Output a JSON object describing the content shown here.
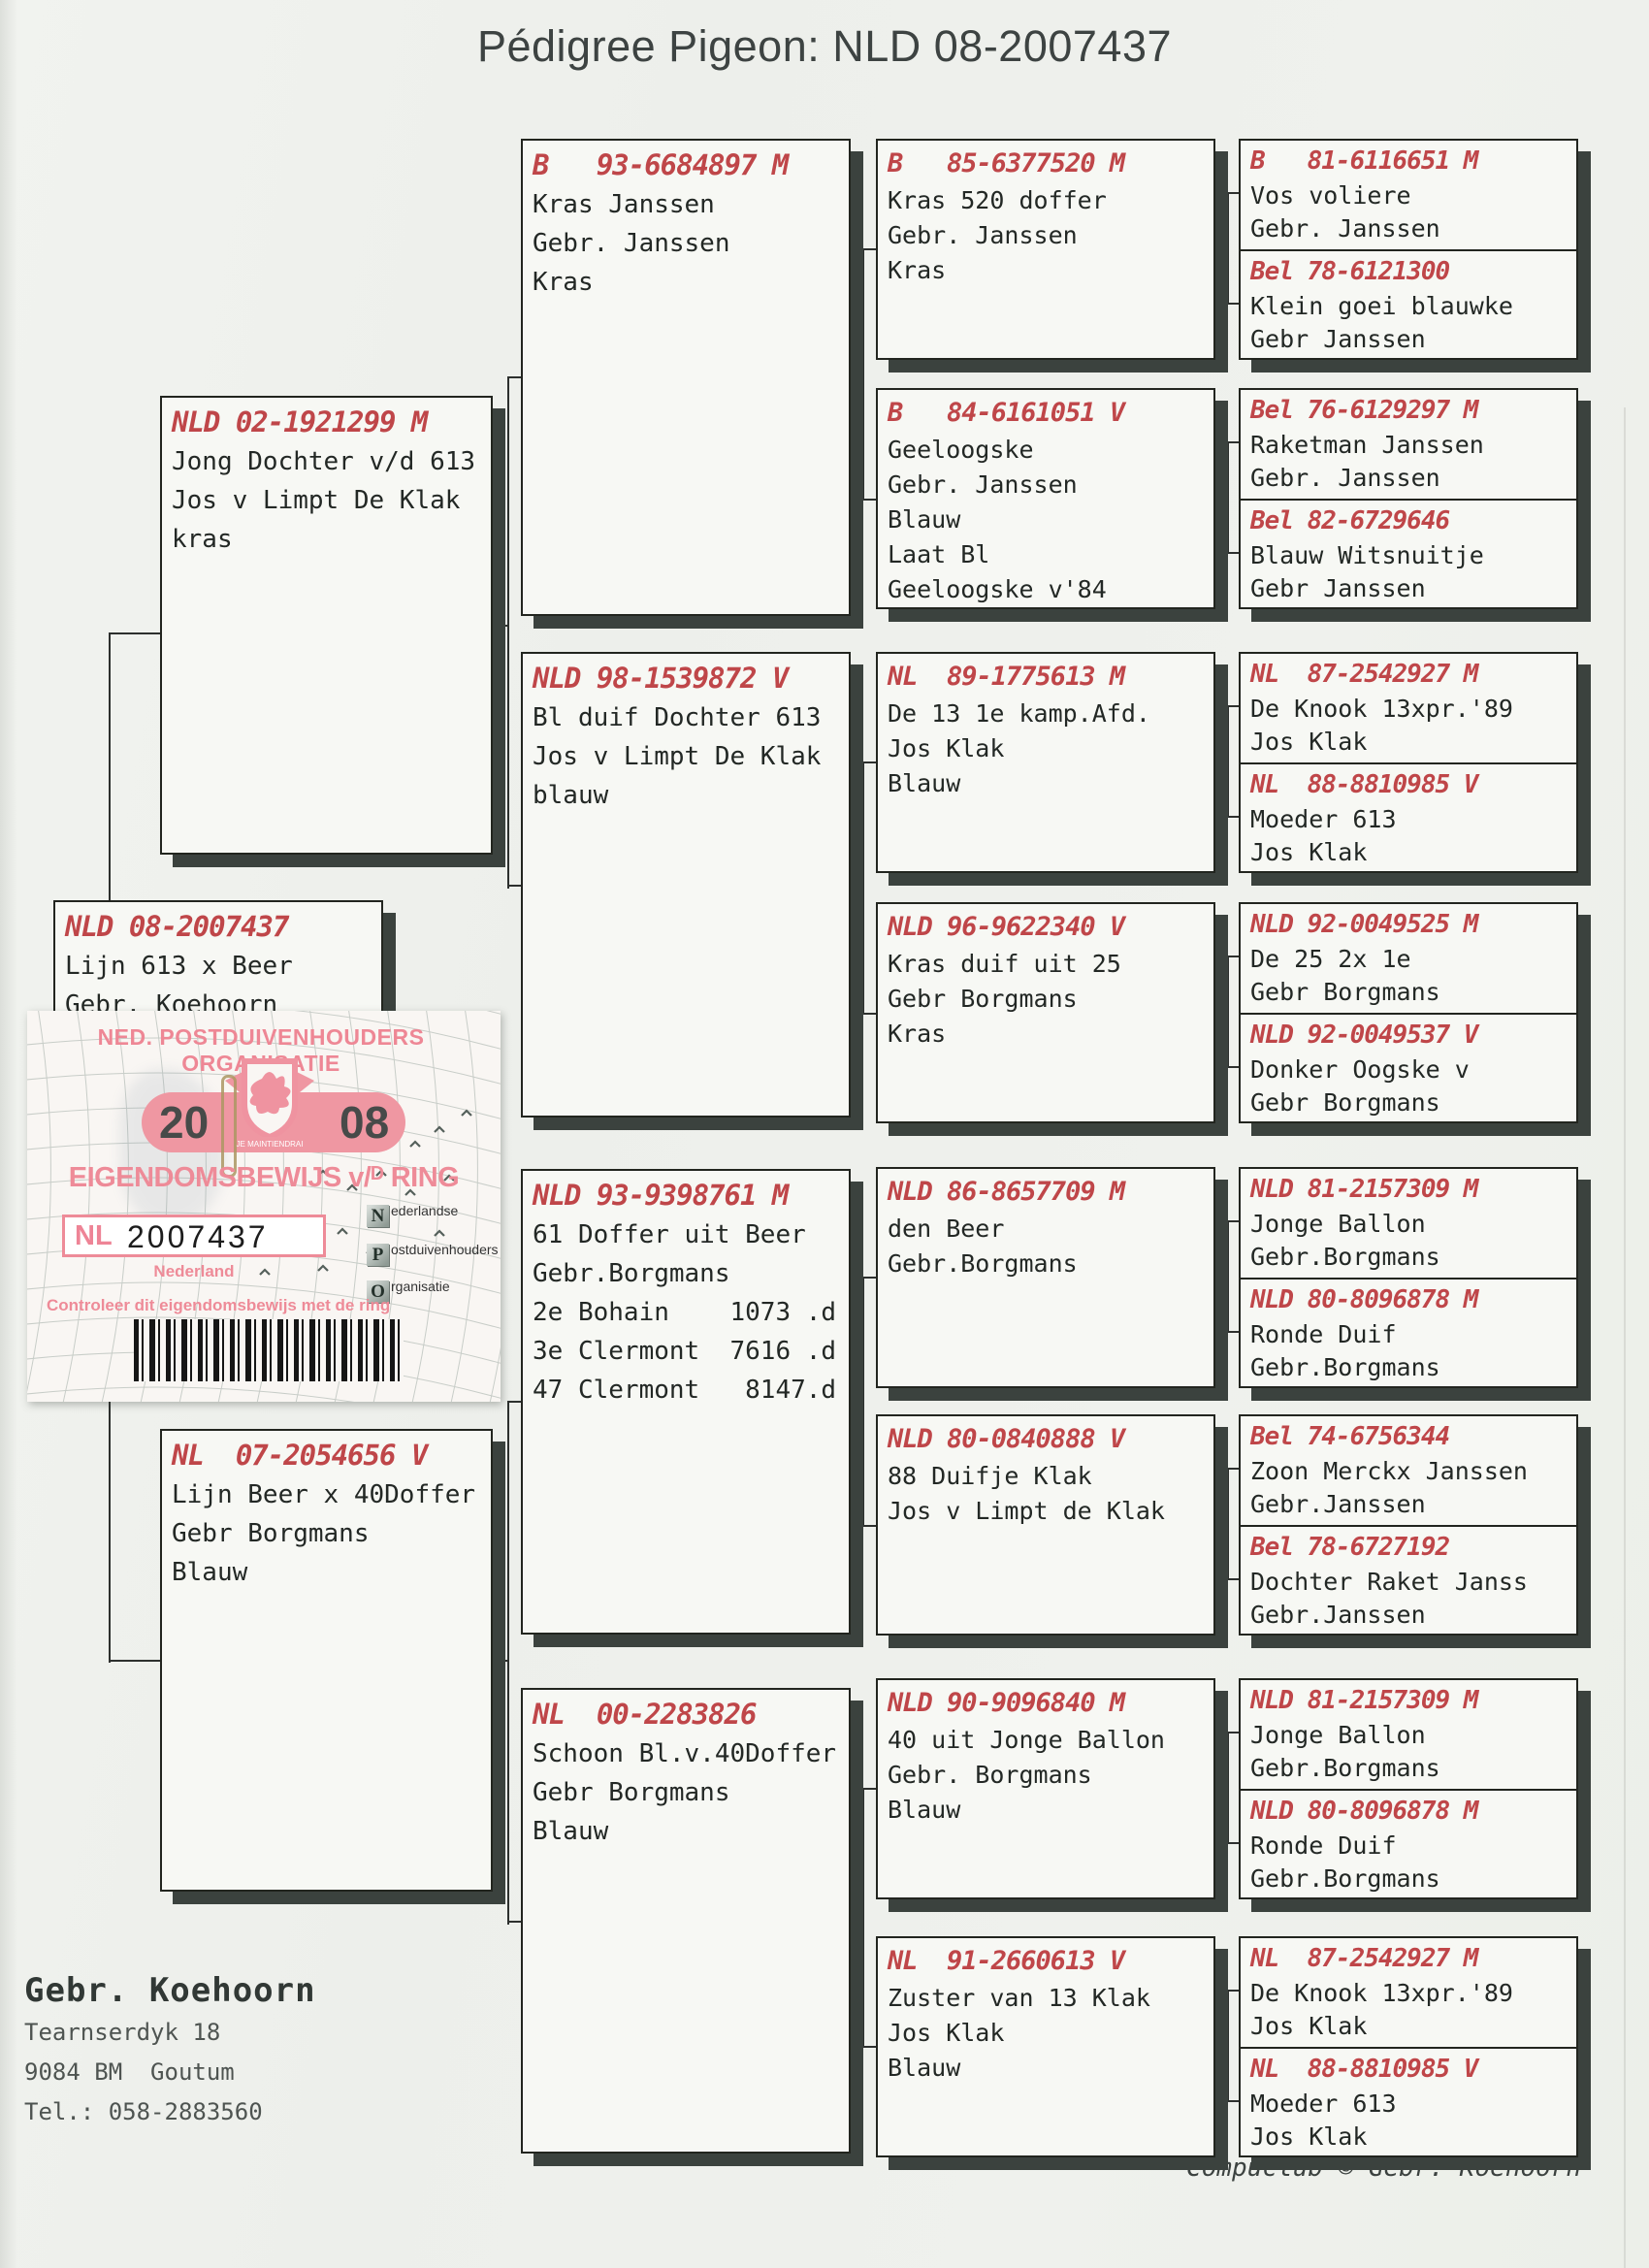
{
  "title": "Pédigree Pigeon: NLD 08-2007437",
  "colors": {
    "ring_red": "#bf4649",
    "certificate_pink": "#ee8b98",
    "box_shadow": "#3b423e",
    "paper": "#eef0ec"
  },
  "pedigree": {
    "subject": {
      "ring": "NLD 08-2007437",
      "lines": [
        "Lijn 613 x Beer",
        "Gebr. Koehoorn"
      ]
    },
    "parents": [
      {
        "ring": "NLD 02-1921299 M",
        "lines": [
          "Jong Dochter v/d 613",
          "Jos v Limpt De Klak",
          "kras"
        ]
      },
      {
        "ring": "NL  07-2054656 V",
        "lines": [
          "Lijn Beer x 40Doffer",
          "Gebr Borgmans",
          "Blauw"
        ]
      }
    ],
    "grandparents": [
      {
        "ring": "B   93-6684897 M",
        "lines": [
          "Kras Janssen",
          "Gebr. Janssen",
          "Kras"
        ]
      },
      {
        "ring": "NLD 98-1539872 V",
        "lines": [
          "Bl duif Dochter 613",
          "Jos v Limpt De Klak",
          "blauw"
        ]
      },
      {
        "ring": "NLD 93-9398761 M",
        "lines": [
          "61 Doffer uit Beer",
          "Gebr.Borgmans",
          "",
          "2e Bohain    1073 .d",
          "3e Clermont  7616 .d",
          "47 Clermont   8147.d"
        ]
      },
      {
        "ring": "NL  00-2283826",
        "lines": [
          "Schoon Bl.v.40Doffer",
          "Gebr Borgmans",
          "Blauw"
        ]
      }
    ],
    "great_grandparents": [
      {
        "ring": "B   85-6377520 M",
        "lines": [
          "Kras 520 doffer",
          "Gebr. Janssen",
          "Kras"
        ]
      },
      {
        "ring": "B   84-6161051 V",
        "lines": [
          "Geeloogske",
          "Gebr. Janssen",
          "Blauw",
          "Laat Bl",
          "Geeloogske v'84"
        ]
      },
      {
        "ring": "NL  89-1775613 M",
        "lines": [
          "De 13 1e kamp.Afd.",
          "Jos Klak",
          "Blauw"
        ]
      },
      {
        "ring": "NLD 96-9622340 V",
        "lines": [
          "Kras duif uit 25",
          "Gebr Borgmans",
          "Kras"
        ]
      },
      {
        "ring": "NLD 86-8657709 M",
        "lines": [
          "den Beer",
          "Gebr.Borgmans"
        ]
      },
      {
        "ring": "NLD 80-0840888 V",
        "lines": [
          "88 Duifje Klak",
          "Jos v Limpt de Klak"
        ]
      },
      {
        "ring": "NLD 90-9096840 M",
        "lines": [
          "40 uit Jonge Ballon",
          "Gebr. Borgmans",
          "Blauw"
        ]
      },
      {
        "ring": "NL  91-2660613 V",
        "lines": [
          "Zuster van 13 Klak",
          "Jos Klak",
          "Blauw"
        ]
      }
    ],
    "great_great_grandparents": [
      {
        "top": {
          "ring": "B   81-6116651 M",
          "lines": [
            "Vos voliere",
            "Gebr. Janssen"
          ]
        },
        "bottom": {
          "ring": "Bel 78-6121300",
          "lines": [
            "Klein goei blauwke",
            "Gebr Janssen"
          ]
        }
      },
      {
        "top": {
          "ring": "Bel 76-6129297 M",
          "lines": [
            "Raketman Janssen",
            "Gebr. Janssen"
          ]
        },
        "bottom": {
          "ring": "Bel 82-6729646",
          "lines": [
            "Blauw Witsnuitje",
            "Gebr Janssen"
          ]
        }
      },
      {
        "top": {
          "ring": "NL  87-2542927 M",
          "lines": [
            "De Knook 13xpr.'89",
            "Jos Klak"
          ]
        },
        "bottom": {
          "ring": "NL  88-8810985 V",
          "lines": [
            "Moeder 613",
            "Jos Klak"
          ]
        }
      },
      {
        "top": {
          "ring": "NLD 92-0049525 M",
          "lines": [
            "De 25 2x 1e",
            "Gebr Borgmans"
          ]
        },
        "bottom": {
          "ring": "NLD 92-0049537 V",
          "lines": [
            "Donker Oogske v",
            "Gebr Borgmans"
          ]
        }
      },
      {
        "top": {
          "ring": "NLD 81-2157309 M",
          "lines": [
            "Jonge Ballon",
            "Gebr.Borgmans"
          ]
        },
        "bottom": {
          "ring": "NLD 80-8096878 M",
          "lines": [
            "Ronde Duif",
            "Gebr.Borgmans"
          ]
        }
      },
      {
        "top": {
          "ring": "Bel 74-6756344",
          "lines": [
            "Zoon Merckx Janssen",
            "Gebr.Janssen"
          ]
        },
        "bottom": {
          "ring": "Bel 78-6727192",
          "lines": [
            "Dochter Raket Janss",
            "Gebr.Janssen"
          ]
        }
      },
      {
        "top": {
          "ring": "NLD 81-2157309 M",
          "lines": [
            "Jonge Ballon",
            "Gebr.Borgmans"
          ]
        },
        "bottom": {
          "ring": "NLD 80-8096878 M",
          "lines": [
            "Ronde Duif",
            "Gebr.Borgmans"
          ]
        }
      },
      {
        "top": {
          "ring": "NL  87-2542927 M",
          "lines": [
            "De Knook 13xpr.'89",
            "Jos Klak"
          ]
        },
        "bottom": {
          "ring": "NL  88-8810985 V",
          "lines": [
            "Moeder 613",
            "Jos Klak"
          ]
        }
      }
    ]
  },
  "certificate": {
    "org": "NED. POSTDUIVENHOUDERS ORGANISATIE",
    "year_left": "20",
    "year_right": "08",
    "crest_motto": "JE MAINTIENDRAI",
    "heading": "EIGENDOMSBEWIJS v/ᴰ RING",
    "ring_country": "NL",
    "ring_number": "2007437",
    "country_label": "Nederland",
    "npo": [
      {
        "letter": "N",
        "rest": "ederlandse"
      },
      {
        "letter": "P",
        "rest": "ostduivenhouders"
      },
      {
        "letter": "O",
        "rest": "rganisatie"
      }
    ],
    "note": "Controleer dit eigendomsbewijs met de ring"
  },
  "owner": {
    "name": "Gebr. Koehoorn",
    "address1": "Tearnserdyk 18",
    "address2": "9084 BM  Goutum",
    "phone": "Tel.: 058-2883560"
  },
  "footer": "Compuclub © Gebr. Koehoorn"
}
